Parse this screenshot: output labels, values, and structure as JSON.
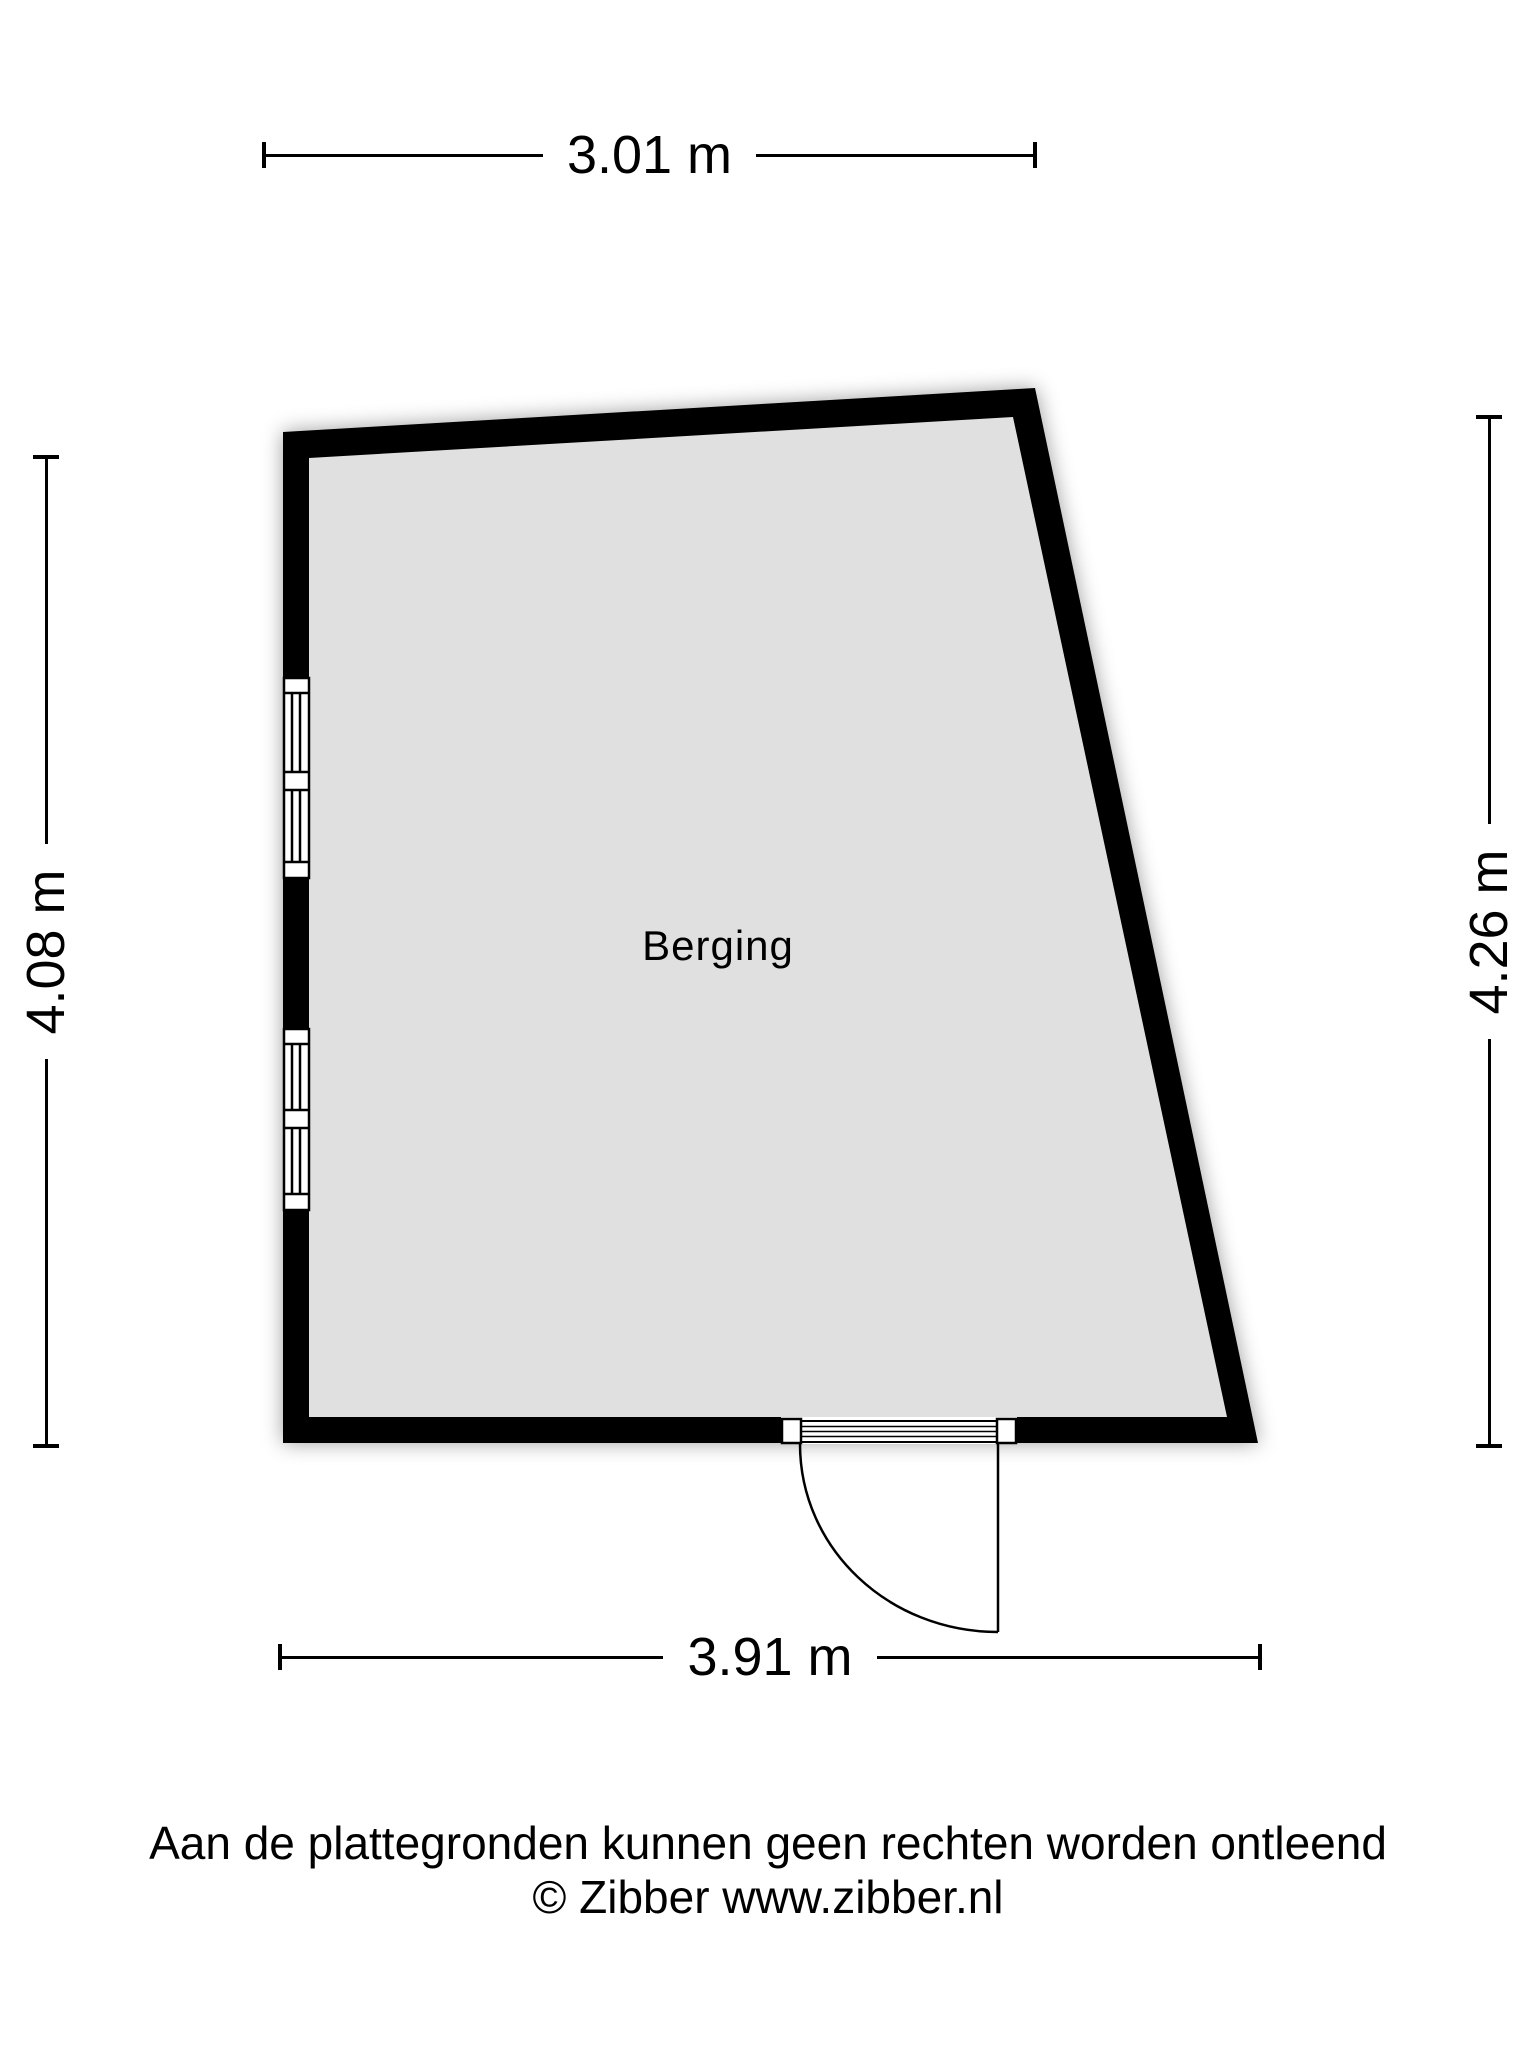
{
  "floorplan": {
    "room": {
      "label": "Berging"
    },
    "dimensions": {
      "top": "3.01 m",
      "bottom": "3.91 m",
      "left": "4.08 m",
      "right": "4.26 m"
    },
    "colors": {
      "wall": "#000000",
      "floor": "#e0e0e0",
      "background": "#ffffff"
    }
  },
  "footer": {
    "disclaimer": "Aan de plattegronden kunnen geen rechten worden ontleend",
    "copyright": "© Zibber www.zibber.nl"
  }
}
